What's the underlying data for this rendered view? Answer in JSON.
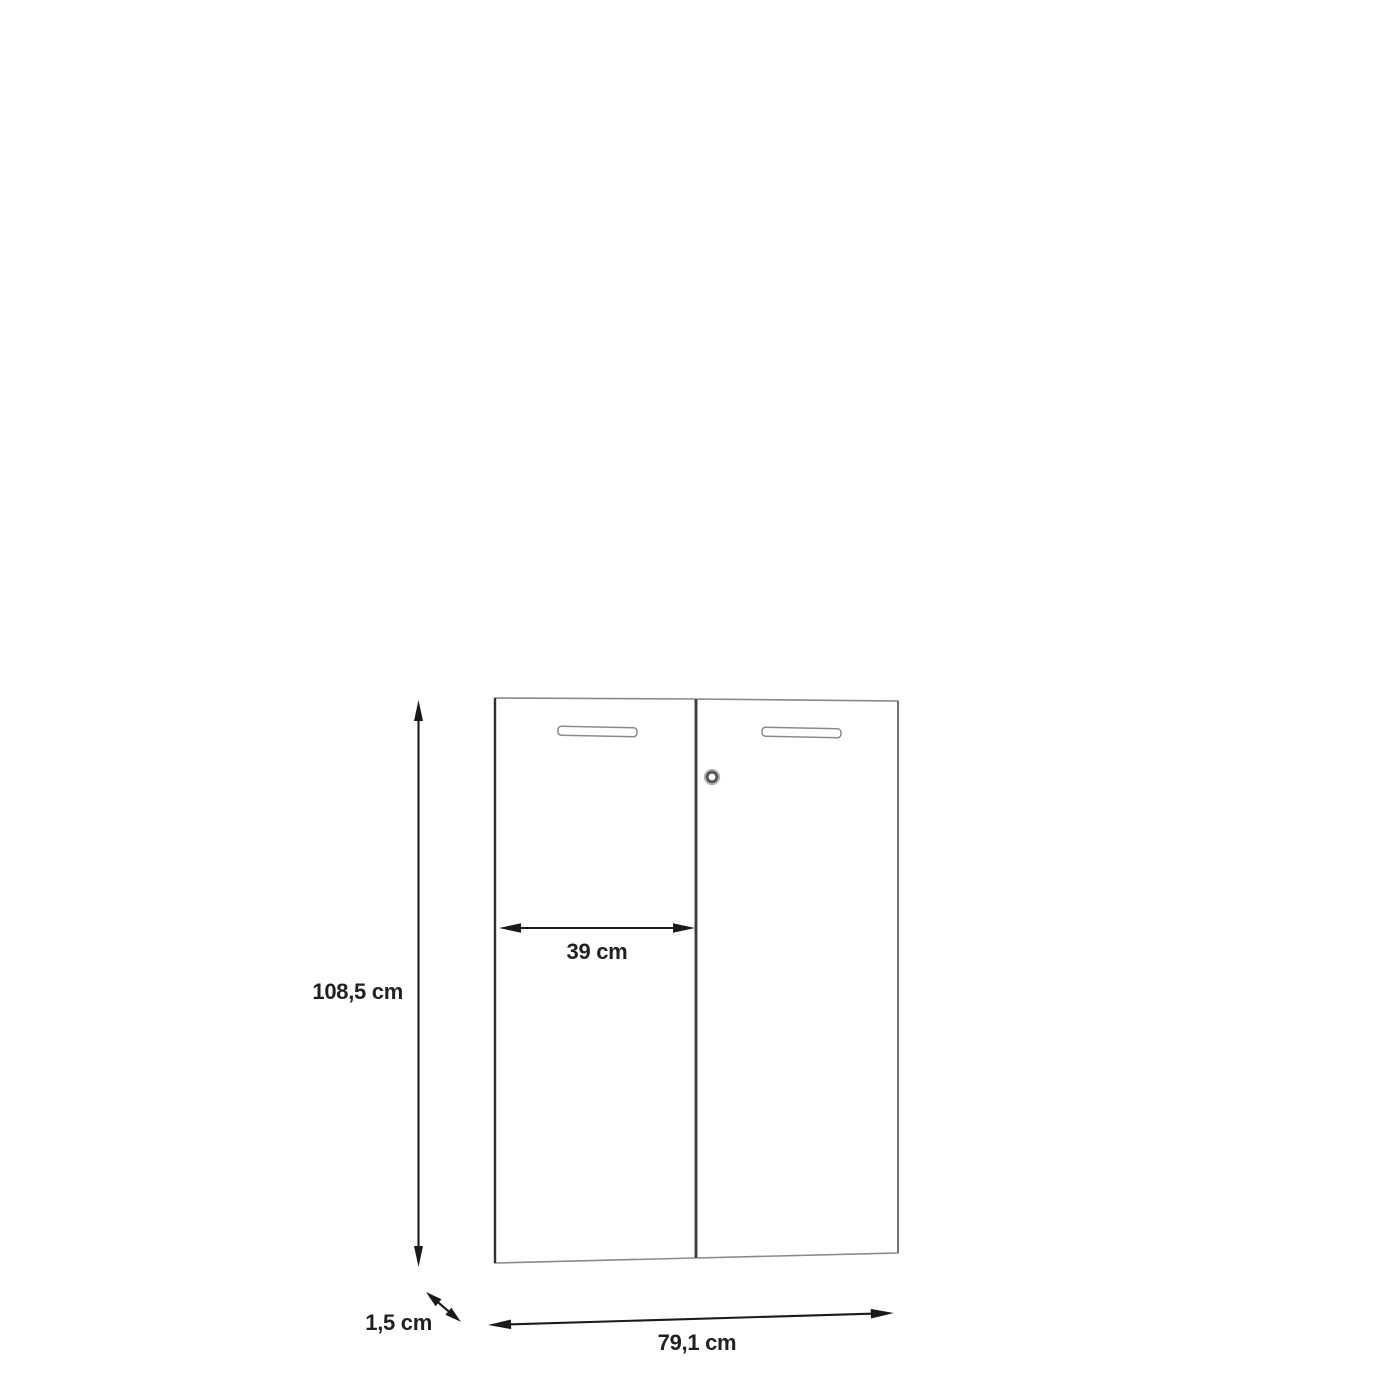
{
  "diagram": {
    "description": "Technical dimension drawing of a pair of cabinet doors, front view with slight perspective",
    "labels": {
      "height": "108,5 cm",
      "door_width": "39 cm",
      "total_width": "79,1 cm",
      "thickness": "1,5 cm"
    },
    "colors": {
      "background": "#ffffff",
      "panel_outline": "#8a8a8a",
      "panel_edge_dark": "#2f2f2f",
      "door_divider": "#3f3f3f",
      "dimension_line": "#1a1a1a",
      "label_text": "#231f20"
    }
  }
}
